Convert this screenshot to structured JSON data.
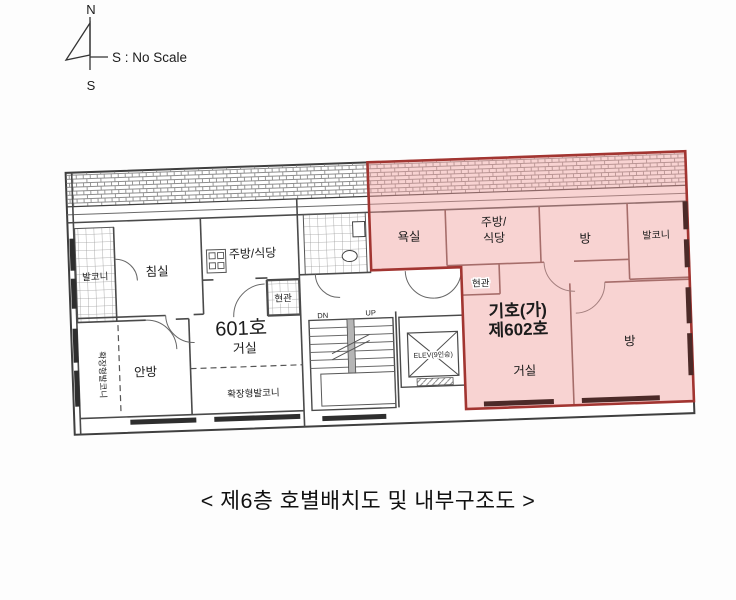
{
  "compass": {
    "north": "N",
    "south": "S",
    "scale_note": "S : No Scale"
  },
  "caption": "< 제6층 호별배치도 및 내부구조도 >",
  "unit_601": {
    "number": "601호",
    "rooms": {
      "balcony": "발코니",
      "bedroom": "침실",
      "kitchen_dining": "주방/식당",
      "entrance": "현관",
      "living": "거실",
      "master_bedroom": "안방",
      "extended_balcony": "확장형발코니",
      "extended_balcony_vertical": "확장형발코니"
    }
  },
  "core": {
    "stairs_down": "DN",
    "stairs_up": "UP",
    "elevator": "ELEV(9인승)"
  },
  "unit_602": {
    "designation_line1": "기호(가)",
    "designation_line2": "제602호",
    "rooms": {
      "bathroom": "욕실",
      "kitchen_dining_line1": "주방/",
      "kitchen_dining_line2": "식당",
      "room_upper": "방",
      "balcony": "발코니",
      "entrance": "현관",
      "living": "거실",
      "room_lower": "방"
    }
  },
  "colors": {
    "highlight_fill": "#ef9e9b",
    "highlight_border": "#a23531",
    "designation_text": "#e02421",
    "plan_line": "#4a4a4a"
  }
}
